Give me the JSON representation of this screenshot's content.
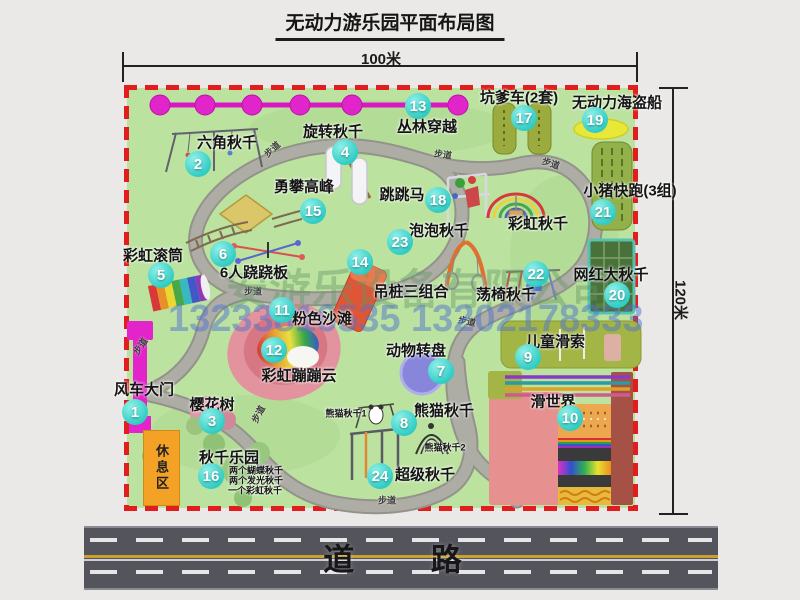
{
  "title": "无动力游乐园平面布局图",
  "dimensions": {
    "width": "100米",
    "height": "120米"
  },
  "road": {
    "label": "道 路"
  },
  "walkway_label": "步道",
  "rest_area_label": "休息区",
  "watermarks": {
    "company": "安游乐设备有限公司",
    "phones": "13233816535 13202178333"
  },
  "pois": {
    "p1": {
      "num": "1",
      "label": "风车大门"
    },
    "p2": {
      "num": "2",
      "label": "六角秋千"
    },
    "p3": {
      "num": "3",
      "label": "樱花树"
    },
    "p4": {
      "num": "4",
      "label": "旋转秋千"
    },
    "p5": {
      "num": "5",
      "label": "彩虹滚筒"
    },
    "p6": {
      "num": "6",
      "label": "6人跷跷板"
    },
    "p7": {
      "num": "7",
      "label": "动物转盘"
    },
    "p8": {
      "num": "8",
      "label": "熊猫秋千",
      "sub1": "熊猫秋千1",
      "sub2": "熊猫秋千2"
    },
    "p9": {
      "num": "9",
      "label": "儿童滑索"
    },
    "p10": {
      "num": "10",
      "label": "滑世界"
    },
    "p11": {
      "num": "11",
      "label": "粉色沙滩"
    },
    "p12": {
      "num": "12",
      "label": "彩虹蹦蹦云"
    },
    "p13": {
      "num": "13",
      "label": "丛林穿越"
    },
    "p14": {
      "num": "14",
      "label": "吊桩三组合"
    },
    "p15": {
      "num": "15",
      "label": "勇攀高峰"
    },
    "p16": {
      "num": "16",
      "label": "秋千乐园",
      "notes": [
        "两个蝴蝶秋千",
        "两个发光秋千",
        "一个彩虹秋千"
      ]
    },
    "p17": {
      "num": "17",
      "label": "坑爹车(2套)"
    },
    "p18": {
      "num": "18",
      "label": "跳跳马"
    },
    "p19": {
      "num": "19",
      "label": "无动力海盗船"
    },
    "p20": {
      "num": "20",
      "label": "网红大秋千"
    },
    "p21": {
      "num": "21",
      "label": "小猪快跑(3组)"
    },
    "p22": {
      "num": "22",
      "label": "荡椅秋千"
    },
    "p23": {
      "num": "23",
      "label": "泡泡秋千"
    },
    "p24": {
      "num": "24",
      "label": "超级秋千"
    },
    "rainbow_swing": {
      "label": "彩虹秋千"
    }
  },
  "colors": {
    "map_green": "#bce2a0",
    "badge_cyan": "#2fccc4",
    "border_red": "#e21d1d",
    "zipline_magenta": "#e324cb",
    "road_gray": "#54545c"
  }
}
